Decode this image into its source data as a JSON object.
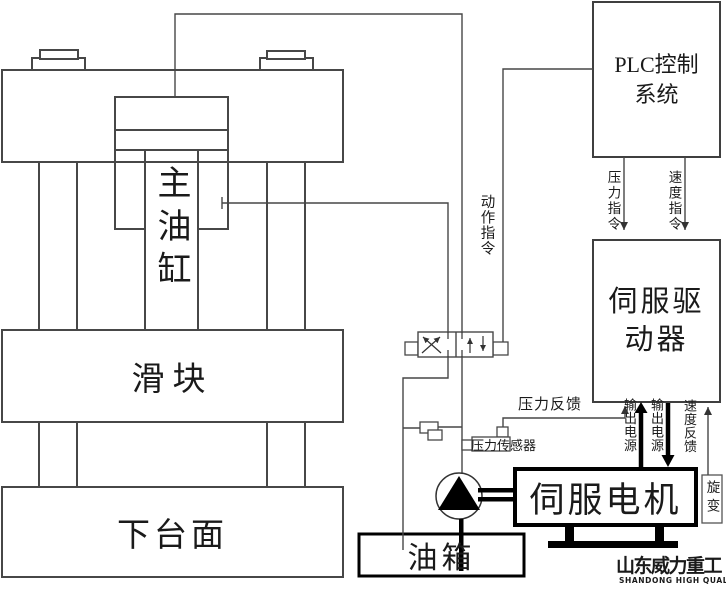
{
  "press": {
    "main_cylinder": "主油缸",
    "slider": "滑块",
    "lower_table": "下台面"
  },
  "plc": {
    "line1": "PLC控制",
    "line2": "系统"
  },
  "servo_driver": {
    "line1": "伺服驱",
    "line2": "动器"
  },
  "servo_motor": {
    "label": "伺服电机"
  },
  "oil_tank": {
    "label": "油箱"
  },
  "resolver": {
    "label": "旋变"
  },
  "signals": {
    "action_command": "动作指令",
    "pressure_command": "压力指令",
    "speed_command": "速度指令",
    "pressure_feedback": "压力反馈",
    "pressure_sensor": "压力传感器",
    "output_power_up": "输出电源",
    "output_power_down": "输出电源",
    "speed_feedback": "速度反馈"
  },
  "logo": {
    "cn": "山东威力重工",
    "en": "SHANDONG HIGH QUALITY"
  },
  "colors": {
    "line": "#404040",
    "thick": "#000000",
    "text": "#1a1a1a",
    "background": "#ffffff"
  }
}
